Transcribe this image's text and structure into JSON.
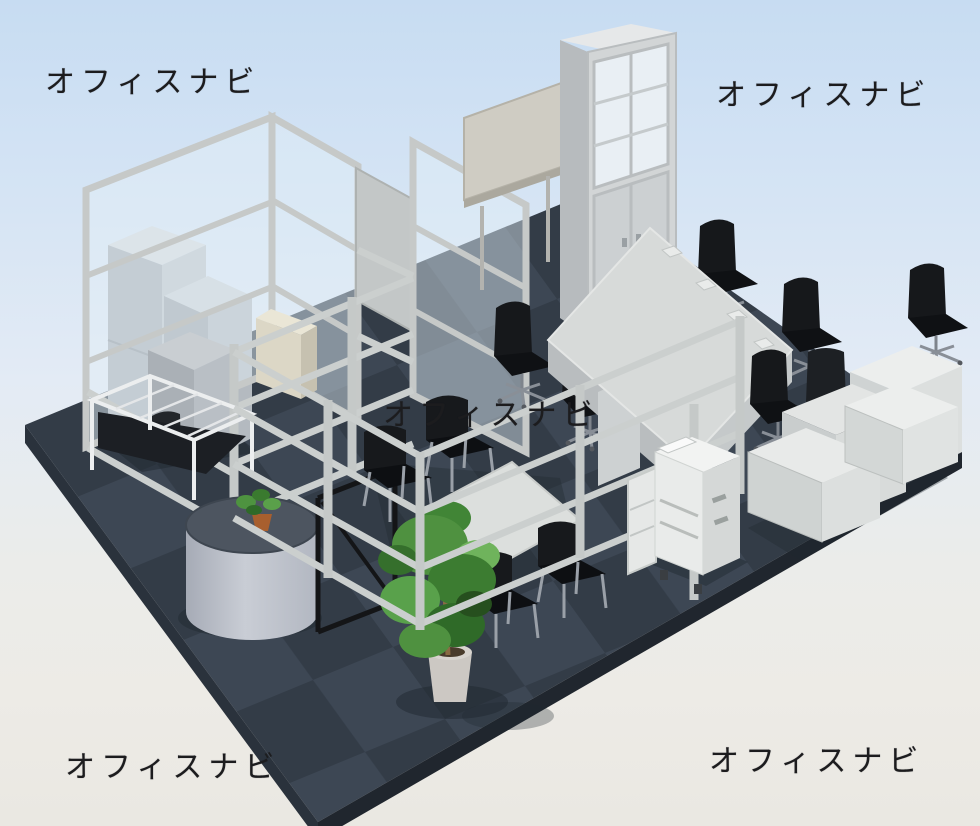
{
  "watermark": {
    "text": "オフィスナビ",
    "color": "#1c1c1e",
    "placements": [
      "top-left",
      "top-right",
      "center",
      "bottom-left",
      "bottom-right"
    ]
  },
  "scene": {
    "type": "isometric-office-layout-render",
    "background": {
      "sky_top": "#c7dcf2",
      "sky_mid": "#e3ebf5",
      "ground": "#edebe6"
    },
    "floor": {
      "tile_light": "#3d4754",
      "tile_dark": "#333c47",
      "slab_edge_left": "#2a323c",
      "slab_edge_right": "#20262e"
    },
    "palette": {
      "frame_gray": "#c9cccb",
      "glass": "#e1edf6",
      "furniture_top": "#e7e9e8",
      "furniture_front": "#cfd3d2",
      "furniture_side": "#b0b6ba",
      "beige": "#dcd7c6",
      "chair_black": "#17191c",
      "chair_leg": "#959ba4",
      "plant_green": "#4f9140",
      "pot_terracotta": "#a85f2e",
      "counter_top": "#4d5560",
      "counter_body": "#bfc3cb",
      "copier_white": "#eceeec"
    },
    "furniture": {
      "left_zone": [
        "glass-partition-screens",
        "storage-lockers",
        "wire-rack",
        "beige-cabinet",
        "round-reception-counter",
        "counter-plant",
        "coat-rack"
      ],
      "back_zone": [
        "whiteboard-panel",
        "tall-cabinet-with-glass-doors"
      ],
      "center_zone": [
        "partition-frame-lattice",
        "small-meeting-table",
        "black-meeting-chairs",
        "tall-potted-plant"
      ],
      "right_zone": [
        "large-meeting-table",
        "office-task-chairs",
        "corner-storage-cabinets",
        "multifunction-copier",
        "low-credenza-cabinets"
      ]
    },
    "counts": {
      "watermarks": 5,
      "black_meeting_chairs": 4,
      "task_chairs": 7,
      "glass_panels": 3
    }
  }
}
